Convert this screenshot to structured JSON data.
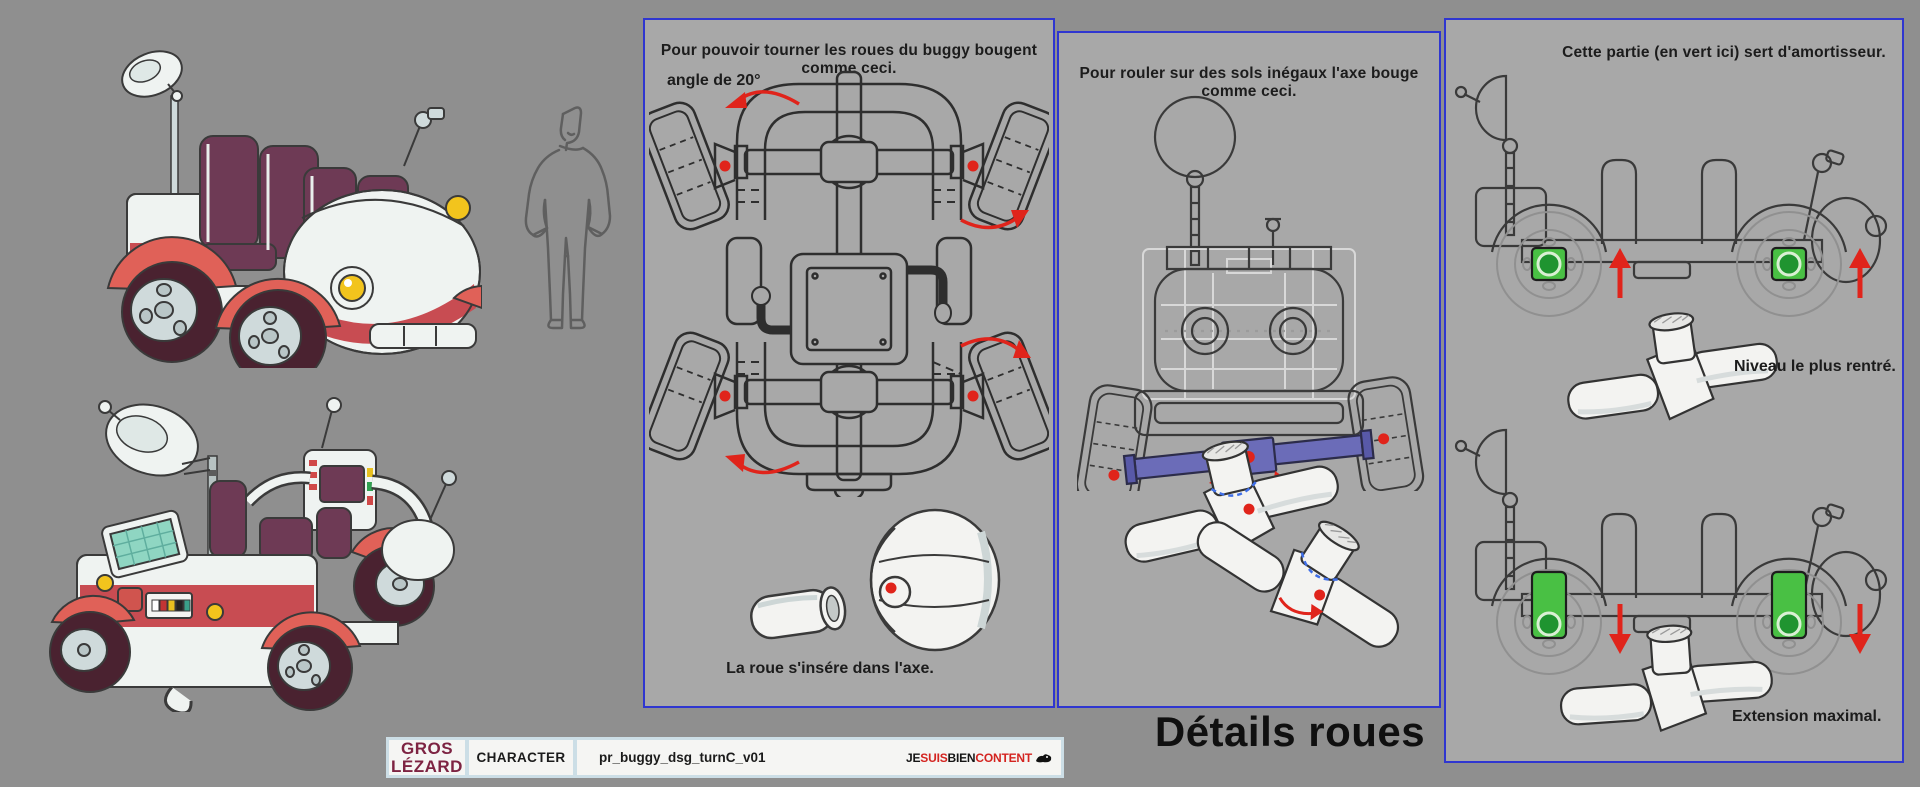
{
  "colors": {
    "bg_outer": "#8f8f8f",
    "bg_panel": "#a8a8a8",
    "panel_border": "#2f36d0",
    "accent_red": "#e0241b",
    "accent_green": "#49c044",
    "accent_green_dark": "#1f9430",
    "accent_purple": "#6b6cb8",
    "accent_blue_dashed": "#3f6fe8",
    "studio_maroon": "#7d2342",
    "logo_red": "#d42420",
    "body_white": "#eff3f1",
    "fender_red": "#e06158",
    "tire_maroon": "#4a2230",
    "seat_plum": "#6e3a55",
    "band_red": "#c84c52",
    "headlight_yellow": "#f2c41d",
    "solar_teal": "#8fd6c2"
  },
  "panels": {
    "turn": {
      "title": "Pour pouvoir tourner les roues du buggy bougent comme ceci.",
      "angle_label": "angle de 20°",
      "caption": "La roue s'insére dans l'axe."
    },
    "axle": {
      "title": "Pour rouler sur des sols inégaux l'axe bouge comme ceci."
    },
    "shock": {
      "title": "Cette partie (en vert ici) sert d'amortisseur.",
      "retracted_label": "Niveau le plus rentré.",
      "extended_label": "Extension maximal."
    }
  },
  "footer": {
    "section_title": "Détails roues"
  },
  "title_block": {
    "studio_line1": "GROS",
    "studio_line2": "LÉZARD",
    "category": "CHARACTER",
    "filename": "pr_buggy_dsg_turnC_v01",
    "logo_segments": [
      {
        "text": "JE",
        "color": "#151515"
      },
      {
        "text": "SUIS",
        "color": "#d42420"
      },
      {
        "text": "BIEN",
        "color": "#151515"
      },
      {
        "text": "CONTENT",
        "color": "#d42420"
      }
    ]
  }
}
